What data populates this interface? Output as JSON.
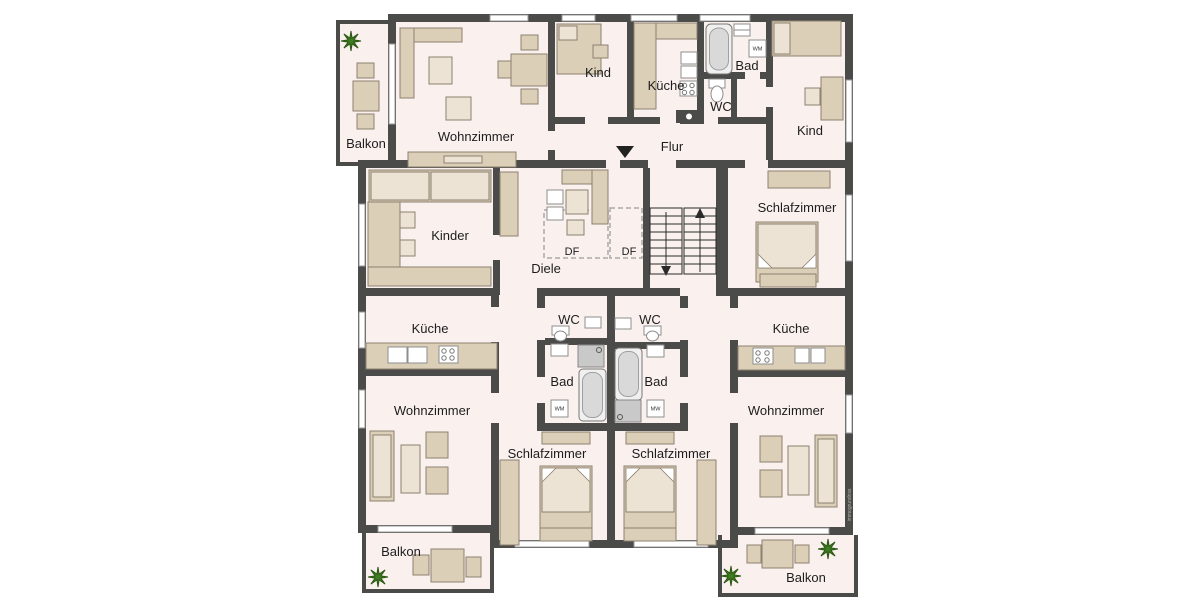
{
  "watermark": "immogrundriss",
  "colors": {
    "wall": "#4b4b49",
    "floor": "#faf1ee",
    "furniture": "#dccfb8",
    "furniture_light": "#ece3d4",
    "plant": "#3f7d21",
    "window": "#ffffff"
  },
  "labels": {
    "balkon_tl": "Balkon",
    "wohnzimmer_tl": "Wohnzimmer",
    "kind_top": "Kind",
    "kueche_top": "Küche",
    "bad_top": "Bad",
    "wm_top": "WM",
    "wc_top": "WC",
    "flur": "Flur",
    "kind_tr": "Kind",
    "schlafzimmer_tr": "Schlafzimmer",
    "kinder": "Kinder",
    "diele": "Diele",
    "df_left": "DF",
    "df_right": "DF",
    "kueche_ml": "Küche",
    "wc_ml": "WC",
    "bad_ml": "Bad",
    "wm_ml": "WM",
    "wc_mr": "WC",
    "bad_mr": "Bad",
    "mw_mr": "MW",
    "kueche_mr": "Küche",
    "wohnzimmer_bl": "Wohnzimmer",
    "schlafzimmer_bl": "Schlafzimmer",
    "schlafzimmer_br": "Schlafzimmer",
    "wohnzimmer_br": "Wohnzimmer",
    "balkon_bl": "Balkon",
    "balkon_br": "Balkon"
  }
}
